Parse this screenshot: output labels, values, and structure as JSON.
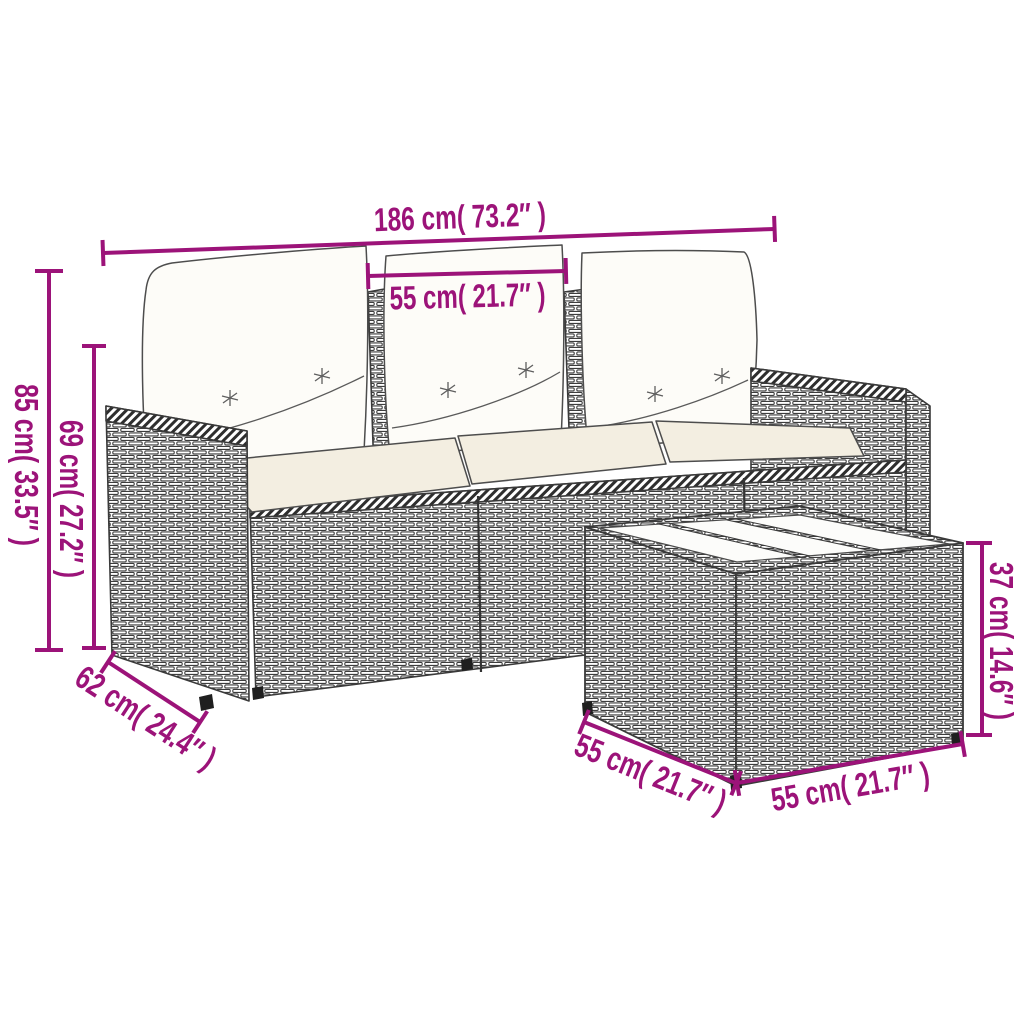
{
  "colors": {
    "dimension": "#9c1379",
    "outline": "#3a3a3a",
    "back_cushion": "#fdfcf8",
    "seat_cushion": "#f3eee1",
    "glass": "#fcfcfa",
    "foot": "#1f1f1f",
    "background": "#ffffff"
  },
  "dimensions": {
    "sofa_total_width": {
      "cm": 186,
      "inches": 73.2,
      "label": "186 cm( 73.2″ )"
    },
    "seat_width": {
      "cm": 55,
      "inches": 21.7,
      "label": "55 cm( 21.7″ )"
    },
    "sofa_total_height": {
      "cm": 85,
      "inches": 33.5,
      "label": "85 cm( 33.5″ )"
    },
    "backrest_height": {
      "cm": 69,
      "inches": 27.2,
      "label": "69 cm( 27.2″ )"
    },
    "sofa_depth": {
      "cm": 62,
      "inches": 24.4,
      "label": "62 cm( 24.4″ )"
    },
    "table_height": {
      "cm": 37,
      "inches": 14.6,
      "label": "37 cm( 14.6″ )"
    },
    "table_depth": {
      "cm": 55,
      "inches": 21.7,
      "label": "55 cm( 21.7″ )"
    },
    "table_width": {
      "cm": 55,
      "inches": 21.7,
      "label": "55 cm( 21.7″ )"
    }
  }
}
